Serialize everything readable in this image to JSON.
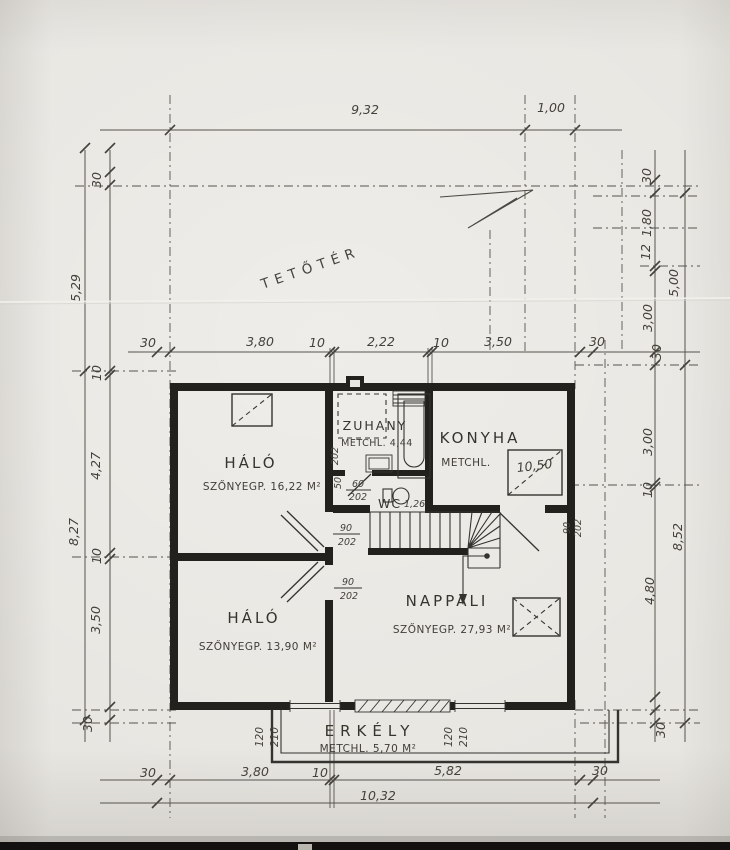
{
  "attic_label": "TETŐTÉR",
  "rooms": {
    "halo_upper": {
      "name": "HÁLÓ",
      "floor": "SZŐNYEGP. 16,22 M²"
    },
    "halo_lower": {
      "name": "HÁLÓ",
      "floor": "SZŐNYEGP. 13,90 M²"
    },
    "zuhany": {
      "name": "ZUHANY",
      "floor": "METCHL. 4,44"
    },
    "konyha": {
      "name": "KONYHA",
      "floor": "METCHL.",
      "counter_area": "10,50"
    },
    "wc": {
      "name": "WC",
      "area": "1,26"
    },
    "nappali": {
      "name": "NAPPALI",
      "floor": "SZŐNYEGP. 27,93 M²"
    },
    "erkely": {
      "name": "ERKÉLY",
      "floor": "METCHL. 5,70 M²"
    }
  },
  "door_labels": {
    "wc": {
      "w": "60",
      "h": "202"
    },
    "wc_wall": "50",
    "shower_height": "202",
    "halo_upper": {
      "w": "90",
      "h": "202"
    },
    "halo_lower": {
      "w": "90",
      "h": "202"
    },
    "konyha": {
      "w": "90",
      "h": "202"
    },
    "balcony_left": {
      "w": "120",
      "h": "210"
    },
    "balcony_right": {
      "w": "120",
      "h": "210"
    }
  },
  "dimensions": {
    "top": {
      "total": "9,32",
      "overhang": "1,00"
    },
    "upper_chain": [
      "30",
      "3,80",
      "10",
      "2,22",
      "10",
      "3,50",
      "30"
    ],
    "bottom_chain": [
      "30",
      "3,80",
      "10",
      "5,82",
      "30"
    ],
    "bottom_total": "10,32",
    "left_outer": [
      "5,29",
      "8,27"
    ],
    "left_inner": [
      "30",
      "10",
      "4,27",
      "10",
      "3,50",
      "30"
    ],
    "right_inner": [
      "30",
      "1,80",
      "12",
      "3,00",
      "30",
      "3,00",
      "10",
      "4,80",
      "30"
    ],
    "right_outer": [
      "5,00",
      "8,52"
    ]
  },
  "colors": {
    "paper": "#e8e6e1",
    "wall_ink": "#22211e",
    "thin_ink": "#55524a",
    "text_ink": "#3a372f"
  }
}
